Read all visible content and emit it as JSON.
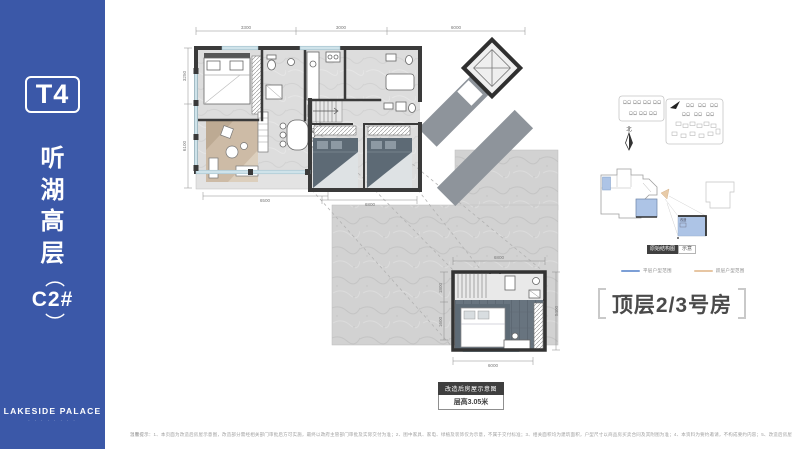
{
  "colors": {
    "sidebar_blue": "#3B58A8",
    "wall_dark": "#3a3a3a",
    "terrace_gray": "#d2d2d2",
    "corridor_gray": "#8e949b",
    "glass_blue": "#cfe3ea",
    "highlight_blue": "#adc4e6",
    "legend_flat_blue": "#7C9FD6",
    "legend_loft_tan": "#E7C6A3"
  },
  "sidebar": {
    "tower": "T4",
    "title_chars": [
      "听",
      "湖",
      "高",
      "层"
    ],
    "paren_open": "（",
    "unit": "C2#",
    "paren_close": "）",
    "brand": "LAKESIDE PALACE",
    "brand_sub": "· · · ·   · · · ·"
  },
  "plan": {
    "dims": {
      "top": [
        "3300",
        "3000",
        "6000"
      ],
      "left": [
        "3250",
        "6100"
      ],
      "living_bottom": "6500",
      "bed_bottom": "6800",
      "loft_top": "6800",
      "loft_bottom": "6000",
      "loft_right": "5400",
      "loft_left": [
        "1800",
        "1600"
      ]
    },
    "badge_title": "改造后房屋示意图",
    "badge_sub": "层高3.05米"
  },
  "aside": {
    "north": "北",
    "struct_badge": "原始结构图",
    "struct_badge_sub": "示意",
    "legend": [
      {
        "label": "平层户型范围",
        "color": "#7C9FD6"
      },
      {
        "label": "跃层户型范围",
        "color": "#E7C6A3"
      }
    ],
    "mini_tag": "改造",
    "title": "顶层2/3号房"
  },
  "footer": {
    "prefix": "温馨提示：",
    "text": "1、本页面为改造后房屋示意图，改造部分需经相关部门审批后方可实施，最终以政府主管部门审批及实际交付为准；2、图中家具、家电、绿植及装饰仅为示意，不属于交付标准；3、相关面积均为建筑面积，户型尺寸以商品房买卖合同及其附图为准；4、本资料为要约邀请，不构成要约内容；5、改造后房屋使用功能将发生变化，相关风险由买受人自行承担；6、敬请留意销售现场最新公示信息。"
  }
}
